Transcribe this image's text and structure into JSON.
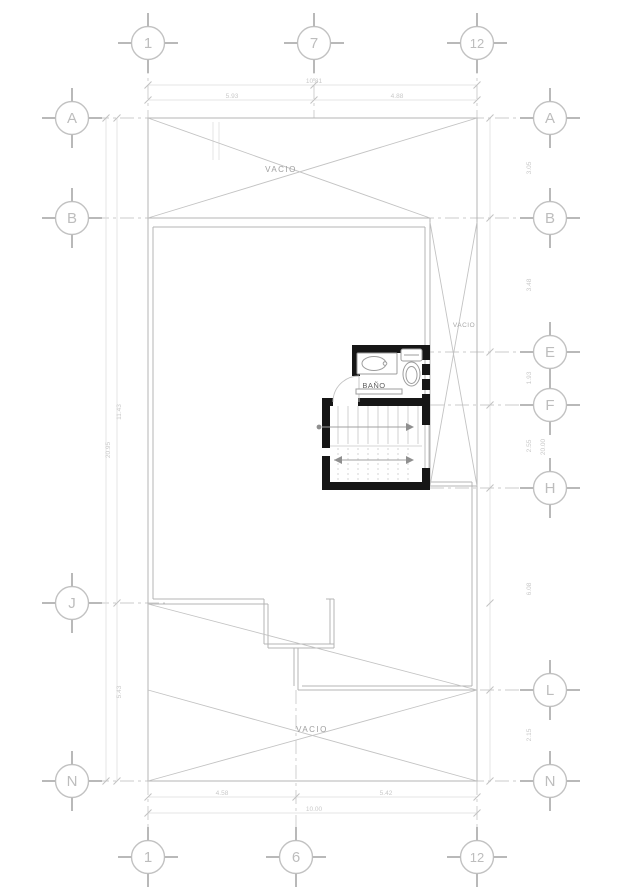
{
  "drawing": {
    "rooms": {
      "bano_label": "BAÑO"
    },
    "voids": {
      "top": "VACIO",
      "right": "VACIO",
      "bottom": "VACIO"
    }
  },
  "grid": {
    "top": [
      "1",
      "7",
      "12"
    ],
    "bottom": [
      "1",
      "6",
      "12"
    ],
    "left": [
      "A",
      "B",
      "J",
      "N"
    ],
    "right": [
      "A",
      "B",
      "E",
      "F",
      "H",
      "L",
      "N"
    ]
  },
  "dims": {
    "top_overall": "10.81",
    "top_seg1": "5.93",
    "top_seg2": "4.88",
    "bottom_seg1": "4.58",
    "bottom_seg2": "5.42",
    "bottom_overall": "10.00",
    "left_seg1": "11.43",
    "left_seg2": "5.43",
    "left_overall": "20.95",
    "right_seg1": "3.05",
    "right_seg2": "3.48",
    "right_seg3": "1.93",
    "right_seg4": "2.55",
    "right_seg5": "6.08",
    "right_seg6": "2.15",
    "right_overall": "20.00"
  },
  "colors": {
    "wall_black": "#161616",
    "line_gray": "#b4b4b4",
    "dim_gray": "#c9c9c9"
  }
}
